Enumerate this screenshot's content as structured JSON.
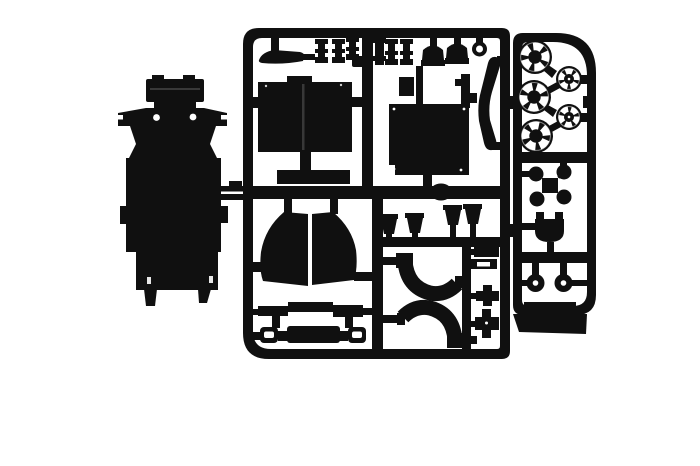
{
  "scene": {
    "title": "Photo of black injection-molded model kit parts: a chassis base plate and two sprue frames of parts on a white background",
    "background_color": "#ffffff",
    "plastic_color": "#101010",
    "plastic_dark": "#0a0a0a",
    "seam_color": "#383838",
    "highlight_color": "#ffffff"
  },
  "sprues": {
    "chassis": {
      "label": "chassis base plate part"
    },
    "main": {
      "label": "main parts sprue frame with cockpit box, engine box, panels, arches and small fittings"
    },
    "wheels": {
      "label": "wheel sprue frame with spoked wheels, hubs and brake parts",
      "large_wheel_count": 3,
      "small_wheel_count": 2
    }
  }
}
